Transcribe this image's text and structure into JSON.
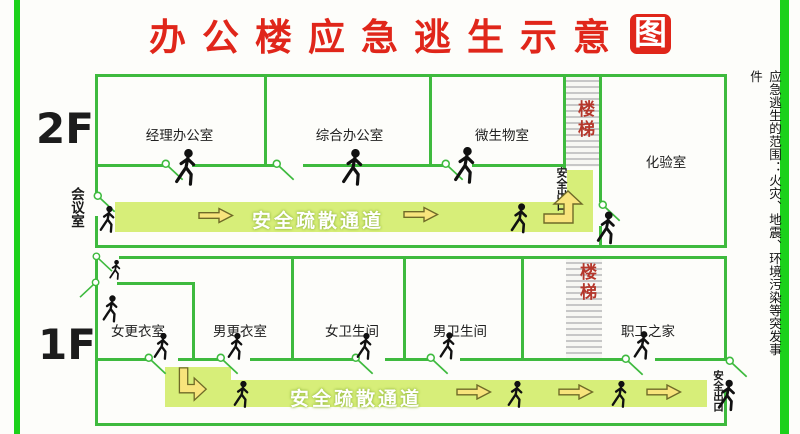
{
  "title": {
    "main": "办公楼应急逃生示意",
    "boxed": "图"
  },
  "side_note": "应急逃生的范围：火灾、地震、环境污染等突发事件",
  "floor2": {
    "label": "2F",
    "rooms": {
      "manager_office": "经理办公室",
      "general_office": "综合办公室",
      "microbiology_room": "微生物室",
      "laboratory": "化验室"
    },
    "meeting_room": "会议室",
    "stairs": "楼梯",
    "corridor": "安全疏散通道",
    "safety_exit": "安全出口"
  },
  "floor1": {
    "label": "1F",
    "rooms": {
      "women_changing": "女更衣室",
      "men_changing": "男更衣室",
      "women_restroom": "女卫生间",
      "men_restroom": "男卫生间",
      "staff_home": "职工之家"
    },
    "stairs": "楼梯",
    "corridor": "安全疏散通道",
    "safety_exit": "安全出口"
  },
  "colors": {
    "title_red": "#e0261a",
    "stairs_red": "#b5372b",
    "wall_green": "#3eba3e",
    "frame_green": "#1bd11b",
    "band_green": "#d7ee79",
    "arrow_yellow": "#f8e47c",
    "person_black": "#111111"
  },
  "icons": {
    "person": "walking-person-icon",
    "arrow_right": "right-arrow-icon",
    "arrow_bent_up": "bent-up-arrow-icon",
    "arrow_bent_down": "bent-down-arrow-icon",
    "door": "door-swing-icon"
  }
}
